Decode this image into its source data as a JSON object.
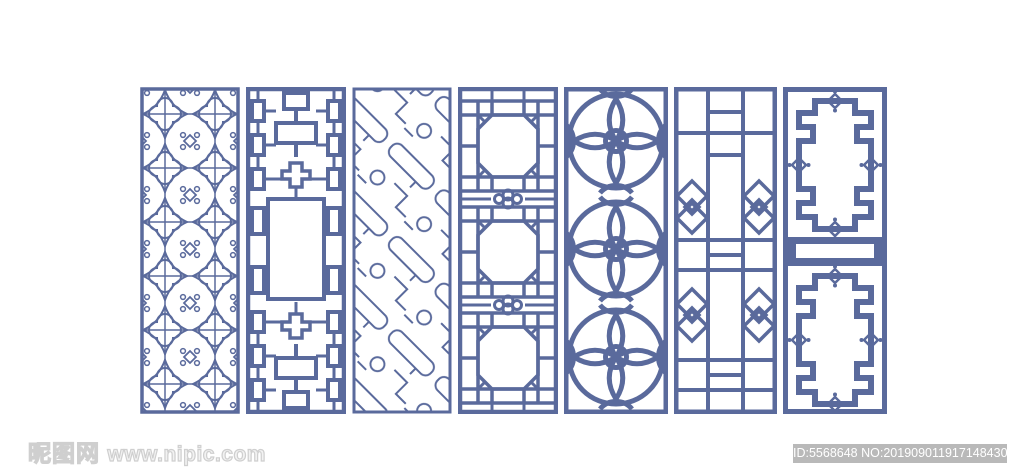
{
  "canvas": {
    "width": 1024,
    "height": 474,
    "background": "#ffffff"
  },
  "palette": {
    "lattice_blue": "#5a6a9c",
    "watermark_outline_gray": "#cfcfcf",
    "id_bar_background": "#b9b9b9",
    "id_bar_text_color": "#ffffff"
  },
  "panels": [
    {
      "name": "quatrefoil-flower-lattice",
      "description": "repeating quatrefoil flowers with scroll ornaments"
    },
    {
      "name": "interlocking-fret-cartouche",
      "description": "interlocked rectangular fretwork around empty center panel"
    },
    {
      "name": "diagonal-fret-with-circles",
      "description": "diagonal stepped fret bands with small circles"
    },
    {
      "name": "octagon-grid-modules",
      "description": "three octagon windows with ruyi clover bands"
    },
    {
      "name": "overlapping-petal-flowers",
      "description": "large four-petal flowers of overlapping circles"
    },
    {
      "name": "column-grid-diamond-lattice",
      "description": "three-column grid with nested diamond motifs"
    },
    {
      "name": "stepped-key-frames",
      "description": "two ornate stepped frames with center slot bar"
    }
  ],
  "watermark": {
    "site_name": "昵图网",
    "site_url": "www.nipic.com"
  },
  "id_bar": {
    "text": "ID:5568648 NO:20190901191714843000"
  }
}
